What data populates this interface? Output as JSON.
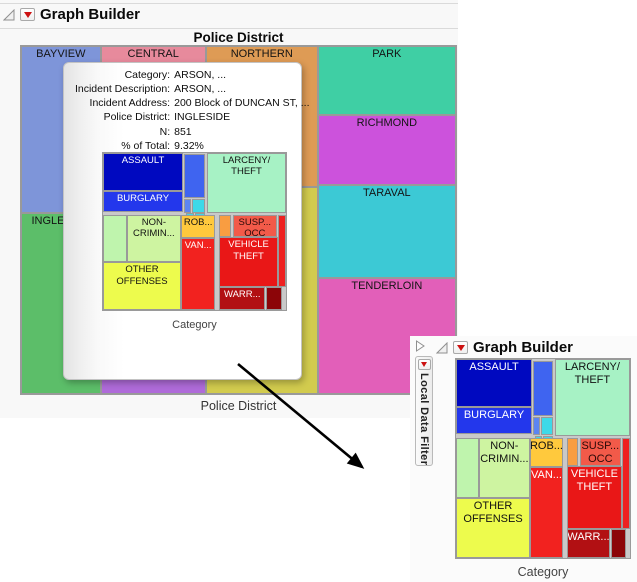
{
  "main_window": {
    "title": "Graph Builder",
    "graph_title": "Police District",
    "x_axis_label": "Police District"
  },
  "filter_window": {
    "title": "Graph Builder",
    "side_tab_label": "Local Data Filter",
    "x_axis_label": "Category"
  },
  "tooltip": {
    "rows": [
      {
        "label": "Category:",
        "value": "ARSON, ..."
      },
      {
        "label": "Incident Description:",
        "value": "ARSON, ..."
      },
      {
        "label": "Incident Address:",
        "value": "200 Block of DUNCAN ST, ..."
      },
      {
        "label": "Police District:",
        "value": "INGLESIDE"
      },
      {
        "label": "N:",
        "value": "851"
      },
      {
        "label": "% of Total:",
        "value": "9.32%"
      }
    ],
    "thumbnail_axis_label": "Category"
  },
  "colors": {
    "accent_red_triangle": "#CC1111",
    "window_background": "#F8F8F8",
    "treemap_border": "#9A9A9A"
  },
  "district_treemap": {
    "cells": [
      {
        "name": "bayview",
        "label": "BAYVIEW",
        "x": 0,
        "y": 0,
        "w": 18.3,
        "h": 48,
        "bg": "#7E95D9",
        "fg": "#141414"
      },
      {
        "name": "ingleside",
        "label": "INGLESIDE",
        "x": 0,
        "y": 48,
        "w": 18.3,
        "h": 52,
        "bg": "#5CBE69",
        "fg": "#141414"
      },
      {
        "name": "central",
        "label": "CENTRAL",
        "x": 18.3,
        "y": 0,
        "w": 24.2,
        "h": 66,
        "bg": "#E78A9C",
        "fg": "#141414"
      },
      {
        "name": "mission",
        "label": "",
        "x": 18.3,
        "y": 66,
        "w": 24.2,
        "h": 34,
        "bg": "#AF6BD9",
        "fg": "#141414"
      },
      {
        "name": "northern",
        "label": "NORTHERN",
        "x": 42.5,
        "y": 0,
        "w": 25.7,
        "h": 40.4,
        "bg": "#DE9B55",
        "fg": "#141414"
      },
      {
        "name": "southern",
        "label": "",
        "x": 42.5,
        "y": 40.4,
        "w": 25.7,
        "h": 59.6,
        "bg": "#D2CB4E",
        "fg": "#141414"
      },
      {
        "name": "park",
        "label": "PARK",
        "x": 68.2,
        "y": 0,
        "w": 31.8,
        "h": 19.7,
        "bg": "#3FCFA4",
        "fg": "#141414"
      },
      {
        "name": "richmond",
        "label": "RICHMOND",
        "x": 68.2,
        "y": 19.7,
        "w": 31.8,
        "h": 20.3,
        "bg": "#CC52DC",
        "fg": "#141414"
      },
      {
        "name": "taraval",
        "label": "TARAVAL",
        "x": 68.2,
        "y": 40,
        "w": 31.8,
        "h": 26.6,
        "bg": "#3CC9D5",
        "fg": "#141414"
      },
      {
        "name": "tenderloin",
        "label": "TENDERLOIN",
        "x": 68.2,
        "y": 66.6,
        "w": 31.8,
        "h": 33.4,
        "bg": "#E25FB9",
        "fg": "#141414"
      }
    ]
  },
  "category_treemap": {
    "cells": [
      {
        "name": "assault",
        "label": "ASSAULT",
        "x": 0,
        "y": 0,
        "w": 43.7,
        "h": 24,
        "bg": "#0009C0",
        "fg": "#FFFFFF"
      },
      {
        "name": "burglary",
        "label": "BURGLARY",
        "x": 0,
        "y": 24,
        "w": 43.7,
        "h": 13.5,
        "bg": "#2337EC",
        "fg": "#FFFFFF"
      },
      {
        "name": "mid-blue",
        "label": "",
        "x": 44.3,
        "y": 0.8,
        "w": 11.4,
        "h": 27.7,
        "bg": "#3F64F0",
        "fg": "#FFFFFF"
      },
      {
        "name": "mid-small-1",
        "label": "",
        "x": 44.3,
        "y": 29,
        "w": 4,
        "h": 9,
        "bg": "#5C85F2",
        "fg": "#FFFFFF"
      },
      {
        "name": "mid-small-2",
        "label": "",
        "x": 48.8,
        "y": 29,
        "w": 6.9,
        "h": 9,
        "bg": "#3DD9E8",
        "fg": "#111111"
      },
      {
        "name": "mid-small-3",
        "label": "",
        "x": 45.3,
        "y": 38.5,
        "w": 4.2,
        "h": 8.8,
        "bg": "#3DD9E8",
        "fg": "#111111"
      },
      {
        "name": "mid-small-4",
        "label": "",
        "x": 50,
        "y": 38.5,
        "w": 5.7,
        "h": 8.8,
        "bg": "#3DD9E8",
        "fg": "#111111"
      },
      {
        "name": "larceny-theft",
        "label": "LARCENY/\nTHEFT",
        "x": 56.8,
        "y": 0,
        "w": 43.2,
        "h": 38.5,
        "bg": "#A7F2C5",
        "fg": "#111111"
      },
      {
        "name": "left-green",
        "label": "",
        "x": 0,
        "y": 39.5,
        "w": 13,
        "h": 30.2,
        "bg": "#BFF4AD",
        "fg": "#111111"
      },
      {
        "name": "non-criminal",
        "label": "NON-\nCRIMIN...",
        "x": 13,
        "y": 39.5,
        "w": 29.6,
        "h": 30.2,
        "bg": "#CEF4A1",
        "fg": "#111111"
      },
      {
        "name": "other-offenses",
        "label": "OTHER\nOFFENSES",
        "x": 0,
        "y": 69.7,
        "w": 42.6,
        "h": 30.3,
        "bg": "#EDFB4D",
        "fg": "#111111"
      },
      {
        "name": "robbery",
        "label": "ROB...",
        "x": 42.6,
        "y": 39.5,
        "w": 18.8,
        "h": 14.7,
        "bg": "#FFC93D",
        "fg": "#111111"
      },
      {
        "name": "vandalism",
        "label": "VAN...",
        "x": 42.6,
        "y": 54.2,
        "w": 18.8,
        "h": 45.8,
        "bg": "#F2221F",
        "fg": "#FFFFFF"
      },
      {
        "name": "orange-sliver",
        "label": "",
        "x": 63.6,
        "y": 39.5,
        "w": 6.3,
        "h": 14.2,
        "bg": "#F99D41",
        "fg": "#111111"
      },
      {
        "name": "susp-occ",
        "label": "SUSP...\nOCC",
        "x": 71,
        "y": 39.5,
        "w": 23.9,
        "h": 14.2,
        "bg": "#F25A49",
        "fg": "#2B0A08"
      },
      {
        "name": "red-sliver",
        "label": "",
        "x": 95.5,
        "y": 39.5,
        "w": 4.5,
        "h": 46.1,
        "bg": "#EE2020",
        "fg": "#FFFFFF"
      },
      {
        "name": "vehicle-theft",
        "label": "VEHICLE\nTHEFT",
        "x": 63.6,
        "y": 53.7,
        "w": 31.9,
        "h": 31.9,
        "bg": "#E91717",
        "fg": "#FFFFFF"
      },
      {
        "name": "warrants",
        "label": "WARR...",
        "x": 63.6,
        "y": 85.6,
        "w": 25,
        "h": 14.4,
        "bg": "#B21013",
        "fg": "#FFFFFF"
      },
      {
        "name": "dark-red",
        "label": "",
        "x": 89.2,
        "y": 85.6,
        "w": 8.5,
        "h": 14.4,
        "bg": "#8C0508",
        "fg": "#FFFFFF"
      }
    ]
  }
}
